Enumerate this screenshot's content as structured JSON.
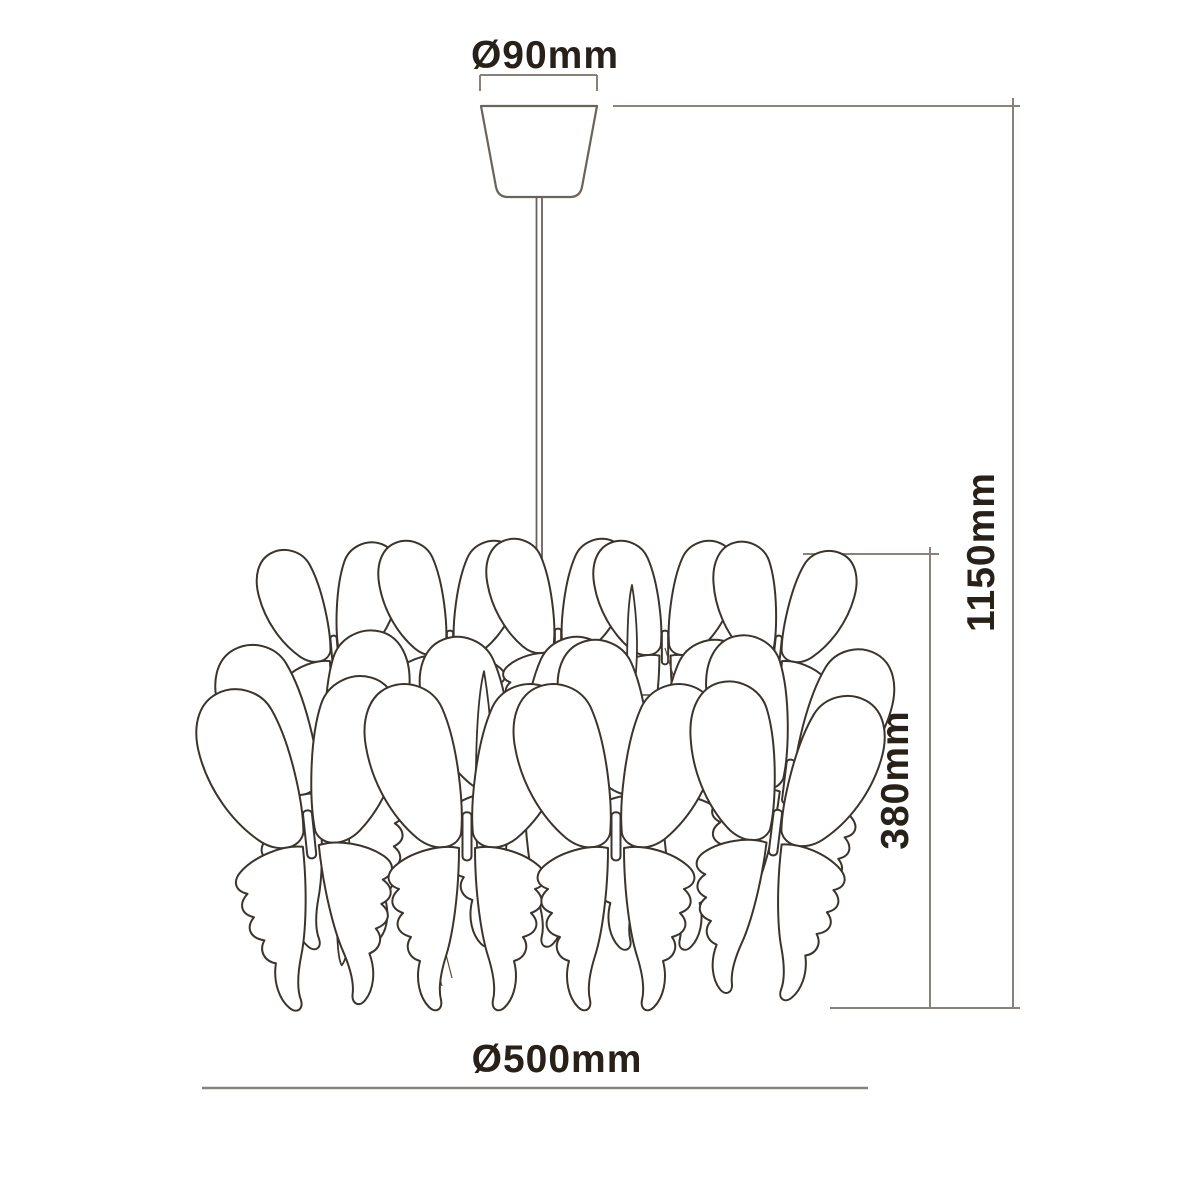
{
  "drawing": {
    "kind": "pendant-lamp-dimension-diagram",
    "labels": {
      "canopy_diameter": "Ø90mm",
      "overall_height": "1150mm",
      "shade_height": "380mm",
      "shade_diameter": "Ø500mm"
    },
    "colors": {
      "background": "#ffffff",
      "butterfly_outline": "#3b342c",
      "hardware_outline": "#6b635a",
      "dimension_line": "#8a8178",
      "label_text": "#272119"
    }
  }
}
